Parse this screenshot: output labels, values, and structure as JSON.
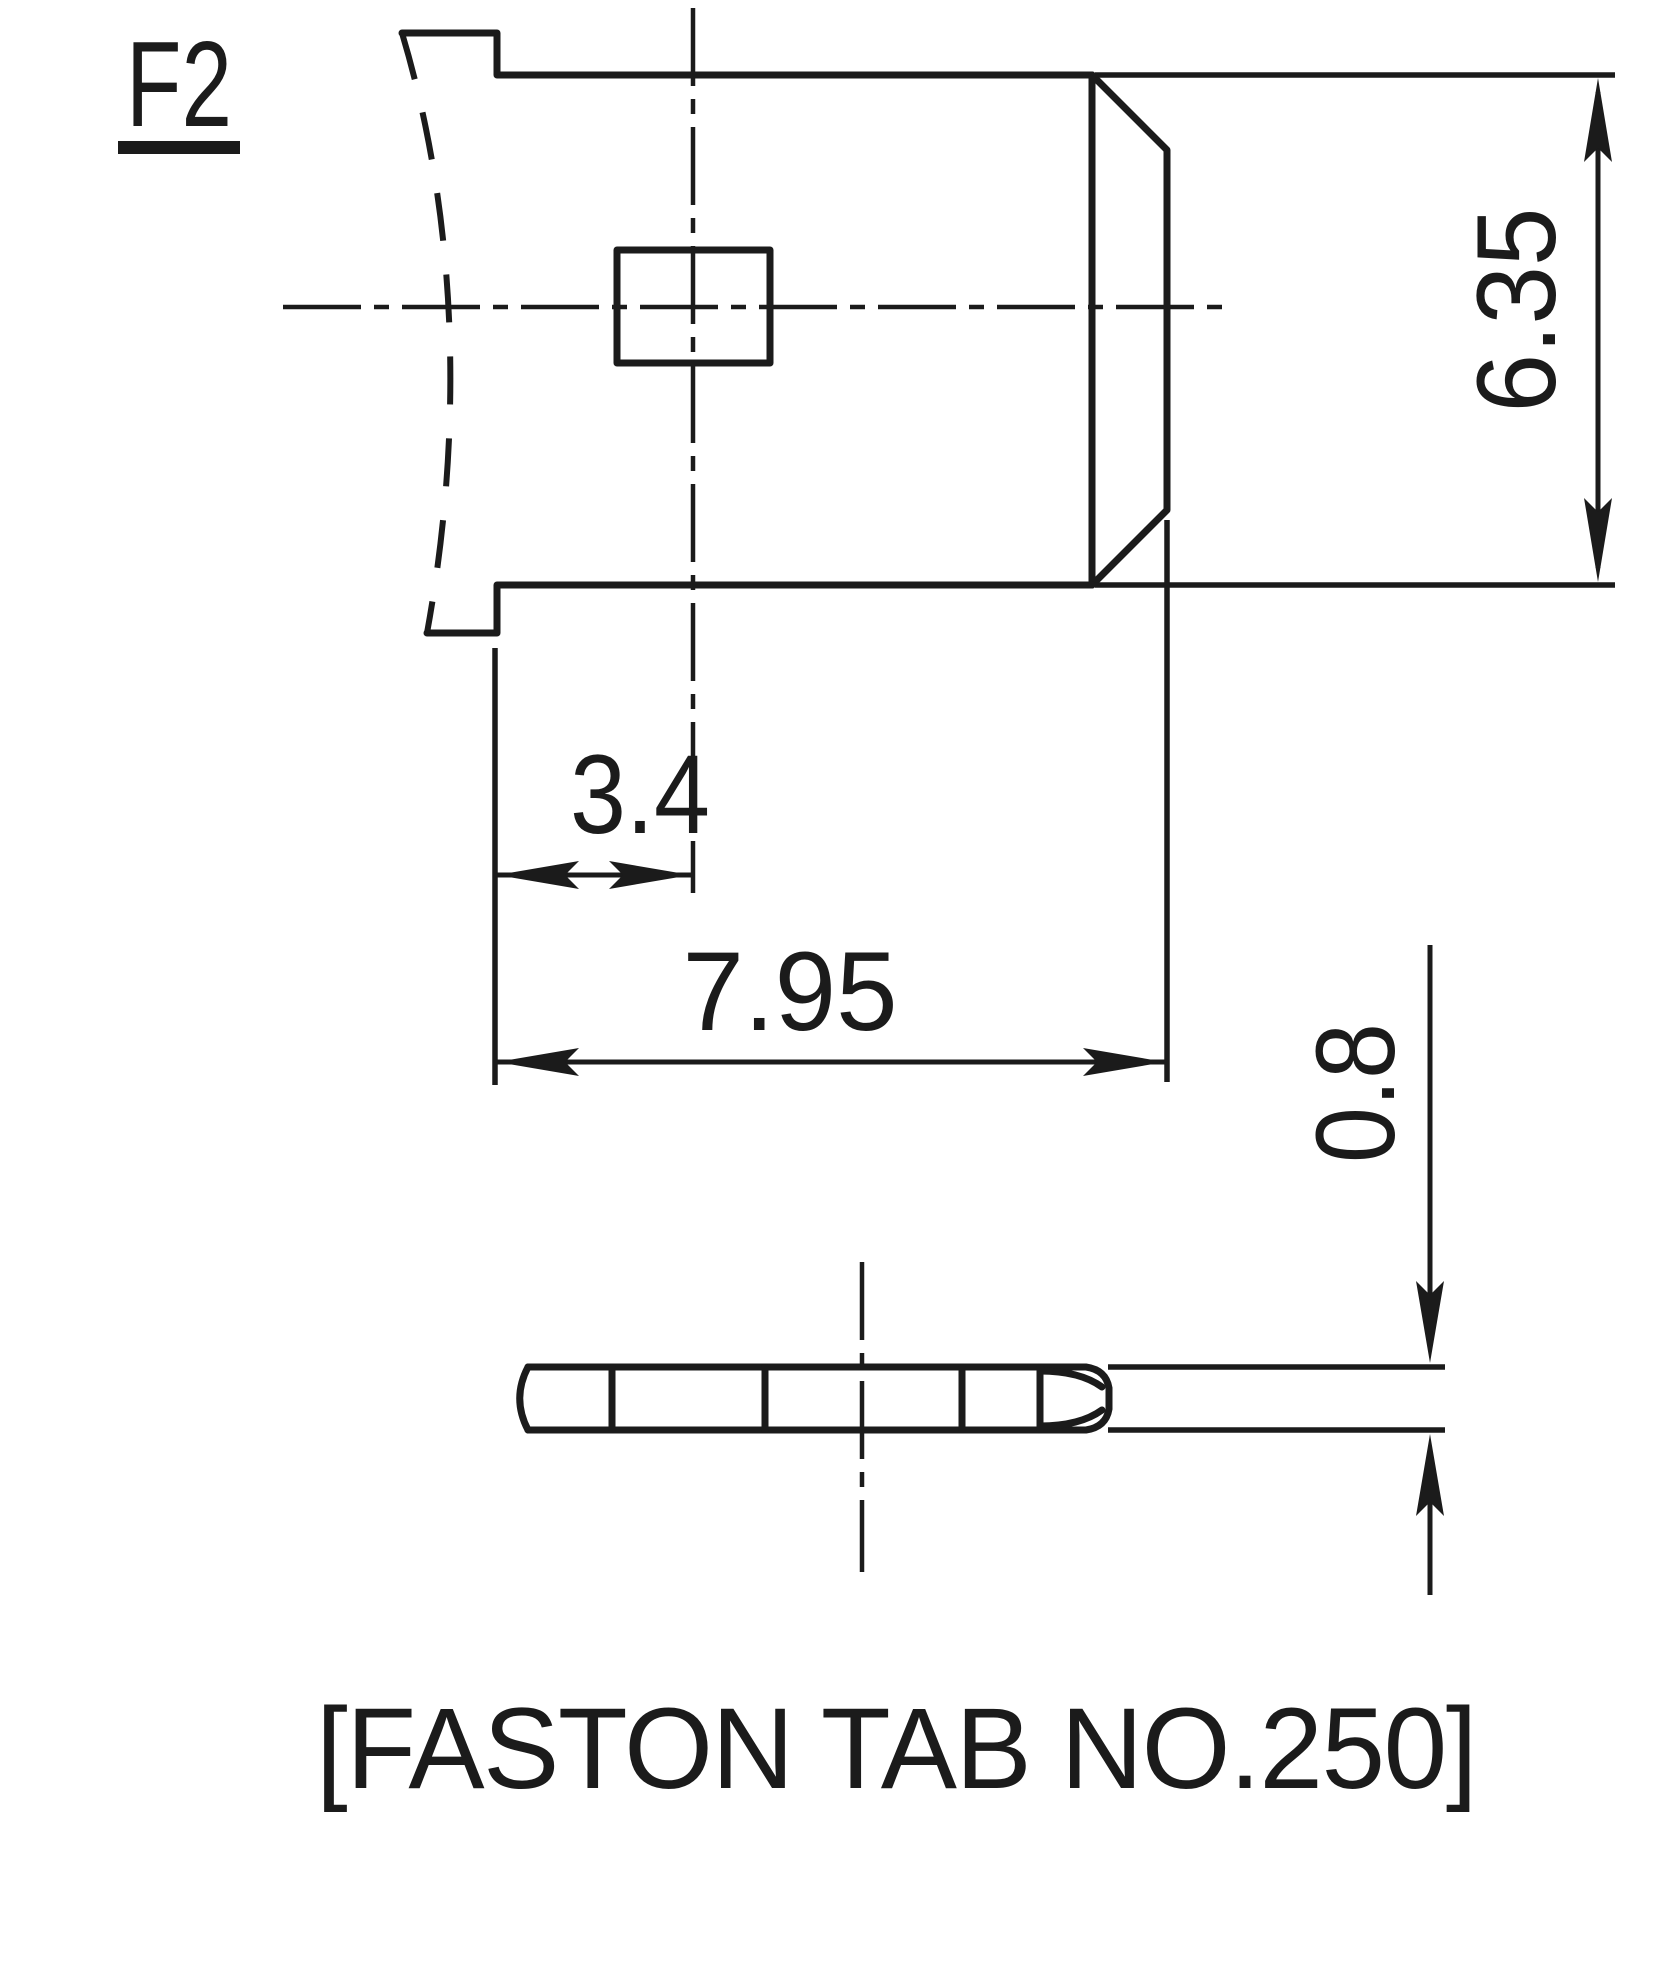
{
  "drawing": {
    "terminal_label": "F2",
    "caption": "[FASTON TAB NO.250]",
    "line_color": "#1b1b1b",
    "background_color": "#ffffff"
  },
  "dimensions": {
    "tab_width": "6.35",
    "hole_center_offset": "3.4",
    "tab_length": "7.95",
    "tab_thickness": "0.8"
  }
}
